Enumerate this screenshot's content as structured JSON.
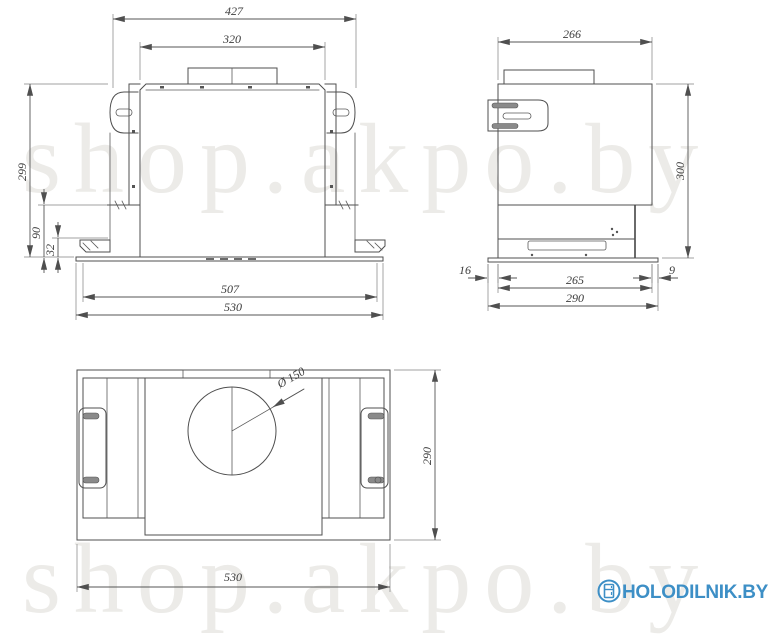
{
  "meta": {
    "type": "technical-dimension-drawing",
    "subject": "built-in cooker hood, three orthographic views",
    "line_color": "#4f4f4f",
    "accent_blue": "#3d8fc6",
    "watermark_color": "#ecebe8",
    "background": "#ffffff"
  },
  "watermark": {
    "text": "shop.akpo.by"
  },
  "logo": {
    "text": "HOLODILNIK.BY",
    "icon": "fridge-icon"
  },
  "views": {
    "front": {
      "title": "front view",
      "dim_overall_width": "427",
      "dim_duct_panel_width": "320",
      "dim_height": "299",
      "dim_lower_height": "90",
      "dim_plinth_height": "32",
      "dim_bottom_inner_width": "507",
      "dim_bottom_overall_width": "530"
    },
    "side": {
      "title": "side view",
      "dim_top_depth": "266",
      "dim_height": "300",
      "dim_front_gap": "16",
      "dim_rear_gap": "9",
      "dim_body_depth": "265",
      "dim_overall_depth": "290"
    },
    "top": {
      "title": "bottom view",
      "dim_duct_diameter": "Ø 150",
      "dim_depth": "290",
      "dim_width": "530"
    }
  }
}
